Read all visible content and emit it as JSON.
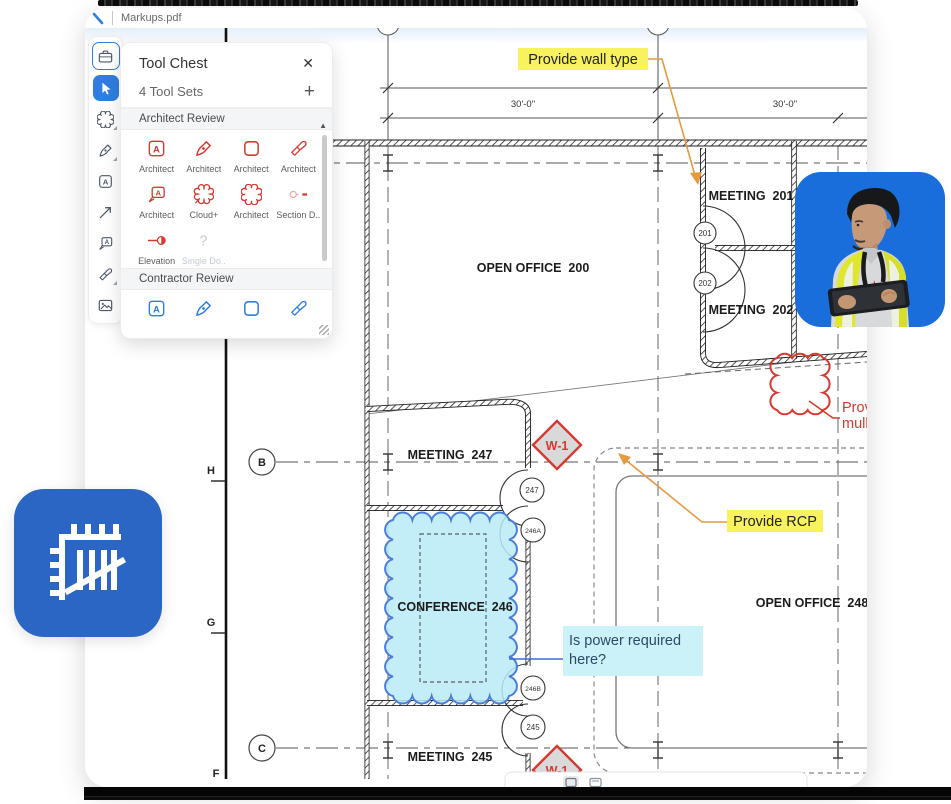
{
  "window": {
    "tab": "Markups.pdf"
  },
  "tool_chest": {
    "title": "Tool Chest",
    "close_glyph": "✕",
    "tool_sets_label": "4 Tool Sets",
    "add_glyph": "+",
    "scroll_up_glyph": "▲",
    "sections": [
      {
        "label": "Architect Review",
        "tools": [
          {
            "label": "Architect",
            "icon": "textbox-icon"
          },
          {
            "label": "Architect",
            "icon": "pen-icon"
          },
          {
            "label": "Architect",
            "icon": "rectangle-icon"
          },
          {
            "label": "Architect",
            "icon": "highlighter-icon"
          },
          {
            "label": "Architect",
            "icon": "callout-icon"
          },
          {
            "label": "Cloud+",
            "icon": "cloud-plus-icon"
          },
          {
            "label": "Architect",
            "icon": "cloud-icon"
          },
          {
            "label": "Section D...",
            "icon": "section-marker-icon"
          },
          {
            "label": "Elevation",
            "icon": "elevation-marker-icon"
          },
          {
            "label": "Single Do...",
            "icon": "question-icon",
            "disabled": true
          }
        ]
      },
      {
        "label": "Contractor Review",
        "tools": [
          {
            "icon": "textbox-icon"
          },
          {
            "icon": "pen-icon"
          },
          {
            "icon": "rectangle-icon"
          },
          {
            "icon": "highlighter-icon"
          }
        ]
      }
    ]
  },
  "drawing": {
    "rooms": {
      "open_office_200": "OPEN OFFICE  200",
      "meeting_201": "MEETING  201",
      "meeting_202": "MEETING  202",
      "meeting_247": "MEETING  247",
      "conference_246": "CONFERENCE  246",
      "open_office_248": "OPEN OFFICE  248",
      "meeting_245": "MEETING  245"
    },
    "door_tags": {
      "d201": "201",
      "d202": "202",
      "d247": "247",
      "d246a": "246A",
      "d246b": "246B",
      "d245": "245"
    },
    "grid": {
      "b": "B",
      "c": "C",
      "h": "H",
      "g": "G",
      "f": "F",
      "dim_left": "30'-0\"",
      "dim_right": "30'-0\""
    },
    "markups": {
      "wall_type": "Provide wall type",
      "rcp": "Provide RCP",
      "power_line1": "Is power required",
      "power_line2": "here?",
      "w1_top": "W-1",
      "w1_bottom": "W-1",
      "mullion_line1": "Prov",
      "mullion_line2": "mulli"
    }
  },
  "colors": {
    "accent_blue": "#2f7de1",
    "markup_red": "#d43a31",
    "highlight_yellow": "#f8f25e",
    "note_cyan_bg": "#cbf2f8",
    "note_cyan_text": "#2c4a66",
    "cloud_fill": "#b9ebf7",
    "cloud_stroke": "#4a7ed8",
    "leader_orange": "#e59a40",
    "photo_bg_blue": "#1a6edb",
    "app_icon_blue": "#2b66c5"
  }
}
